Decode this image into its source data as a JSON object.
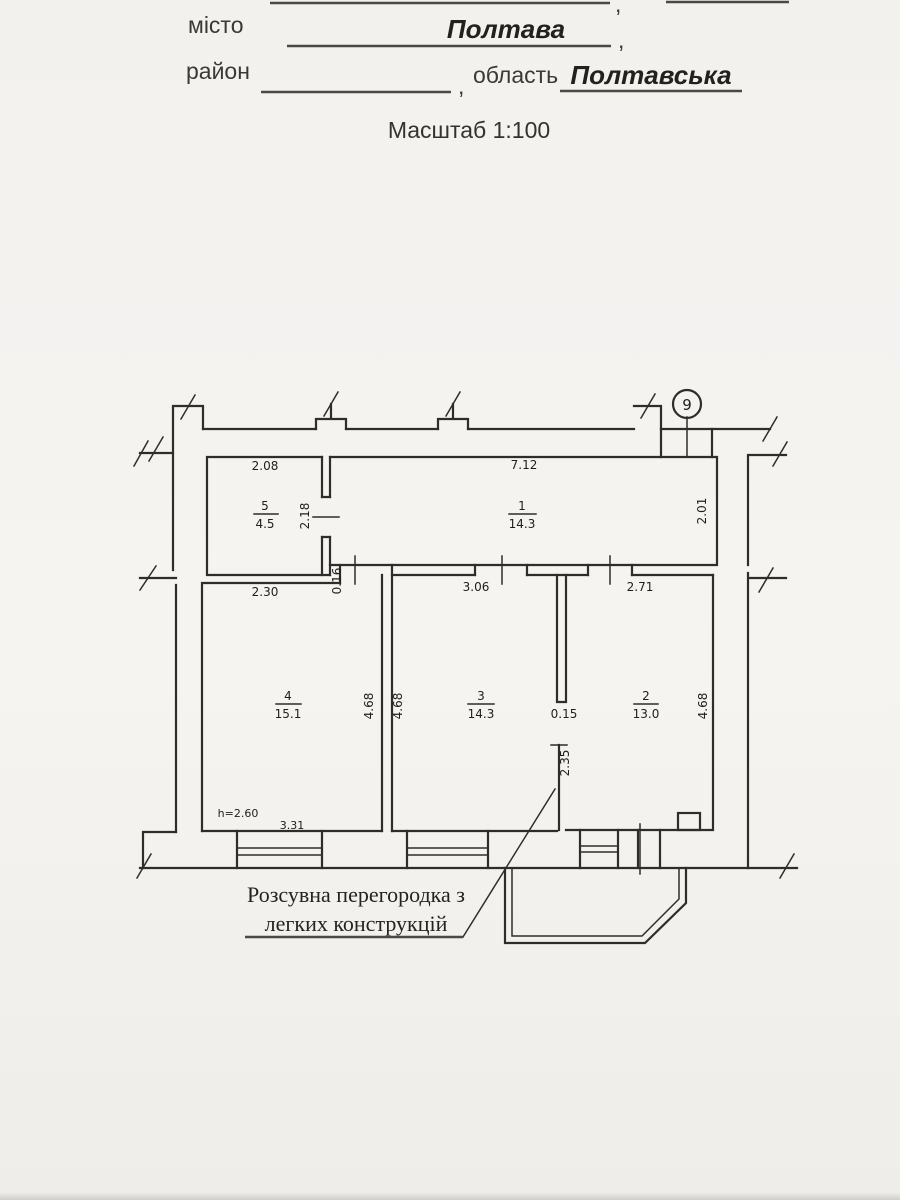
{
  "header": {
    "top_comma": ",",
    "city_label": "місто",
    "city_value": "Полтава",
    "city_comma": ",",
    "district_label": "район",
    "district_comma": ",",
    "oblast_label": "область",
    "oblast_value": "Полтавська",
    "scale_text": "Масштаб 1:100"
  },
  "plan": {
    "axis_number": "9",
    "rooms": [
      {
        "num": "1",
        "area": "14.3"
      },
      {
        "num": "2",
        "area": "13.0"
      },
      {
        "num": "3",
        "area": "14.3"
      },
      {
        "num": "4",
        "area": "15.1"
      },
      {
        "num": "5",
        "area": "4.5"
      }
    ],
    "dims": {
      "room5_width": "2.08",
      "room5_door": "2.18",
      "room1_width": "7.12",
      "room1_right": "2.01",
      "room4_width": "2.30",
      "step": "0.16",
      "room3_top": "3.06",
      "room2_top": "2.71",
      "room4_depth": "4.68",
      "room3_depth": "4.68",
      "room2_depth": "4.68",
      "partition_thickness": "0.15",
      "partition_length": "2.35",
      "ceiling_height": "h=2.60",
      "window_span": "3.31"
    },
    "annotation_line1": "Розсувна перегородка з",
    "annotation_line2": "легких конструкцій"
  }
}
